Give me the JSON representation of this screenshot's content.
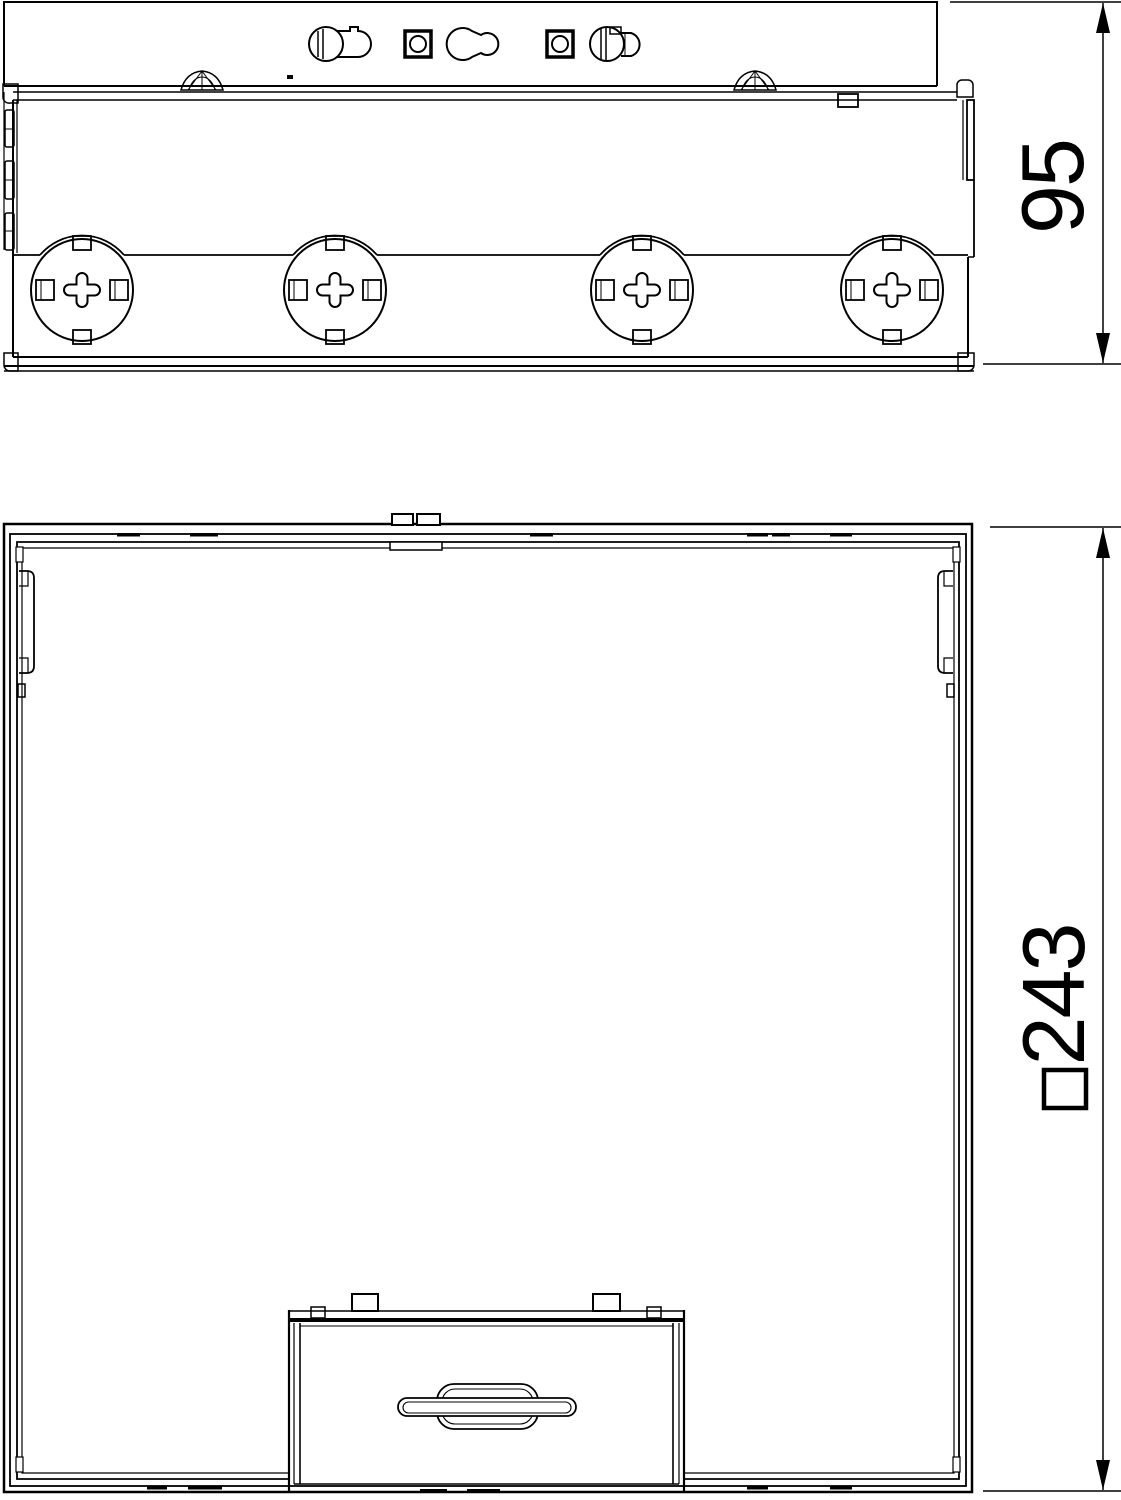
{
  "page": {
    "background": "#ffffff",
    "line_color": "#000000",
    "description": "two-view technical line drawing of a square floor-box / junction box"
  },
  "side_view": {
    "name": "side elevation",
    "dimension_label": "95",
    "knockout_count": 4
  },
  "plan_view": {
    "name": "top view",
    "dimension_label": "243",
    "dimension_prefix": "□"
  }
}
